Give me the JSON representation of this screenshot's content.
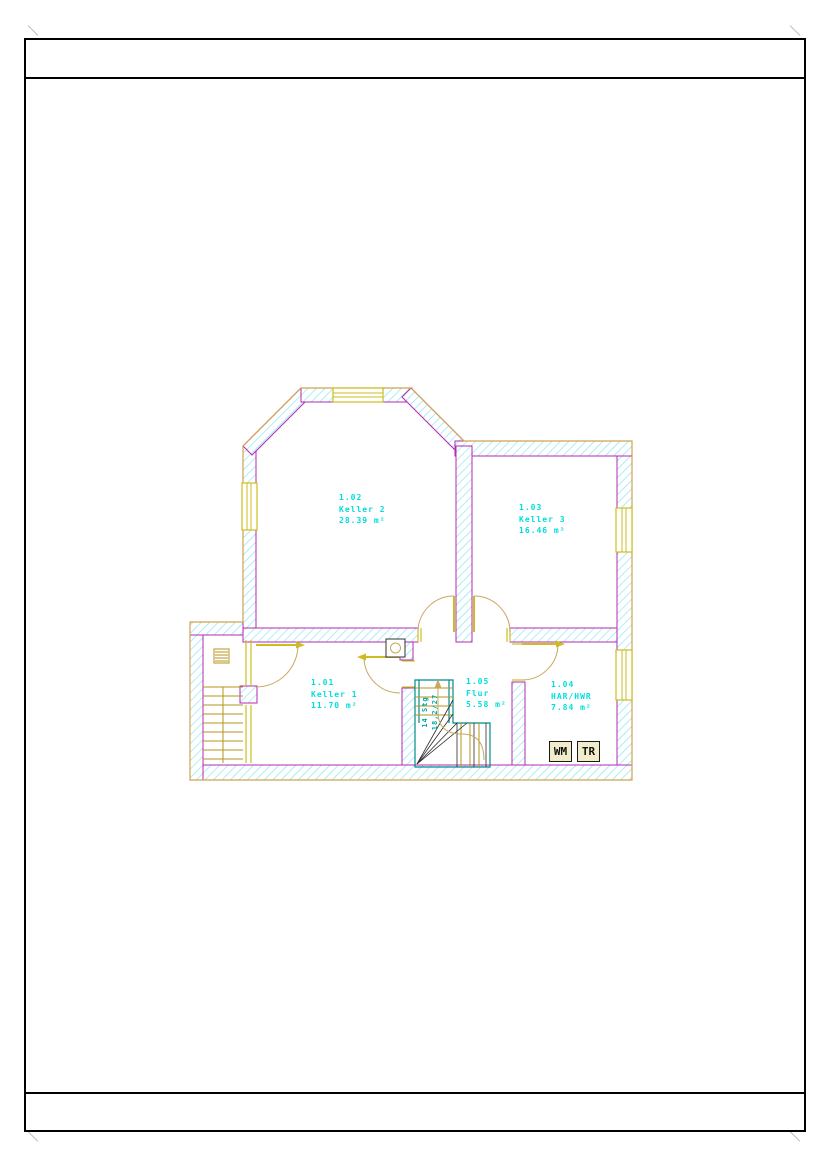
{
  "colors": {
    "frame-border": "#000000",
    "wall-hatch": "#82e4f6",
    "wall-inner": "#b428b4",
    "wall-outer": "#d2a24e",
    "door": "#c9a85c",
    "window-frame": "#cdbe1e",
    "tread": "#b5941c",
    "stair-outline": "#008b8b",
    "winder-line": "#2a2a2a",
    "room-label": "#00dede",
    "stair-text": "#00a8a8",
    "appliance-bg": "#f1edcb",
    "appliance-border": "#1a1a1a"
  },
  "drawing": {
    "rooms": [
      {
        "id": "1.01",
        "name": "Keller 1",
        "area": "11.70 m²"
      },
      {
        "id": "1.02",
        "name": "Keller 2",
        "area": "28.39 m²"
      },
      {
        "id": "1.03",
        "name": "Keller 3",
        "area": "16.46 m²"
      },
      {
        "id": "1.04",
        "name": "HAR/HWR",
        "area": "7.84 m²"
      },
      {
        "id": "1.05",
        "name": "Flur",
        "area": "5.58 m²"
      }
    ],
    "stair_note": {
      "line1": "14 Stg",
      "line2": "18,2/27"
    },
    "appliances": [
      {
        "label": "WM"
      },
      {
        "label": "TR"
      }
    ]
  }
}
